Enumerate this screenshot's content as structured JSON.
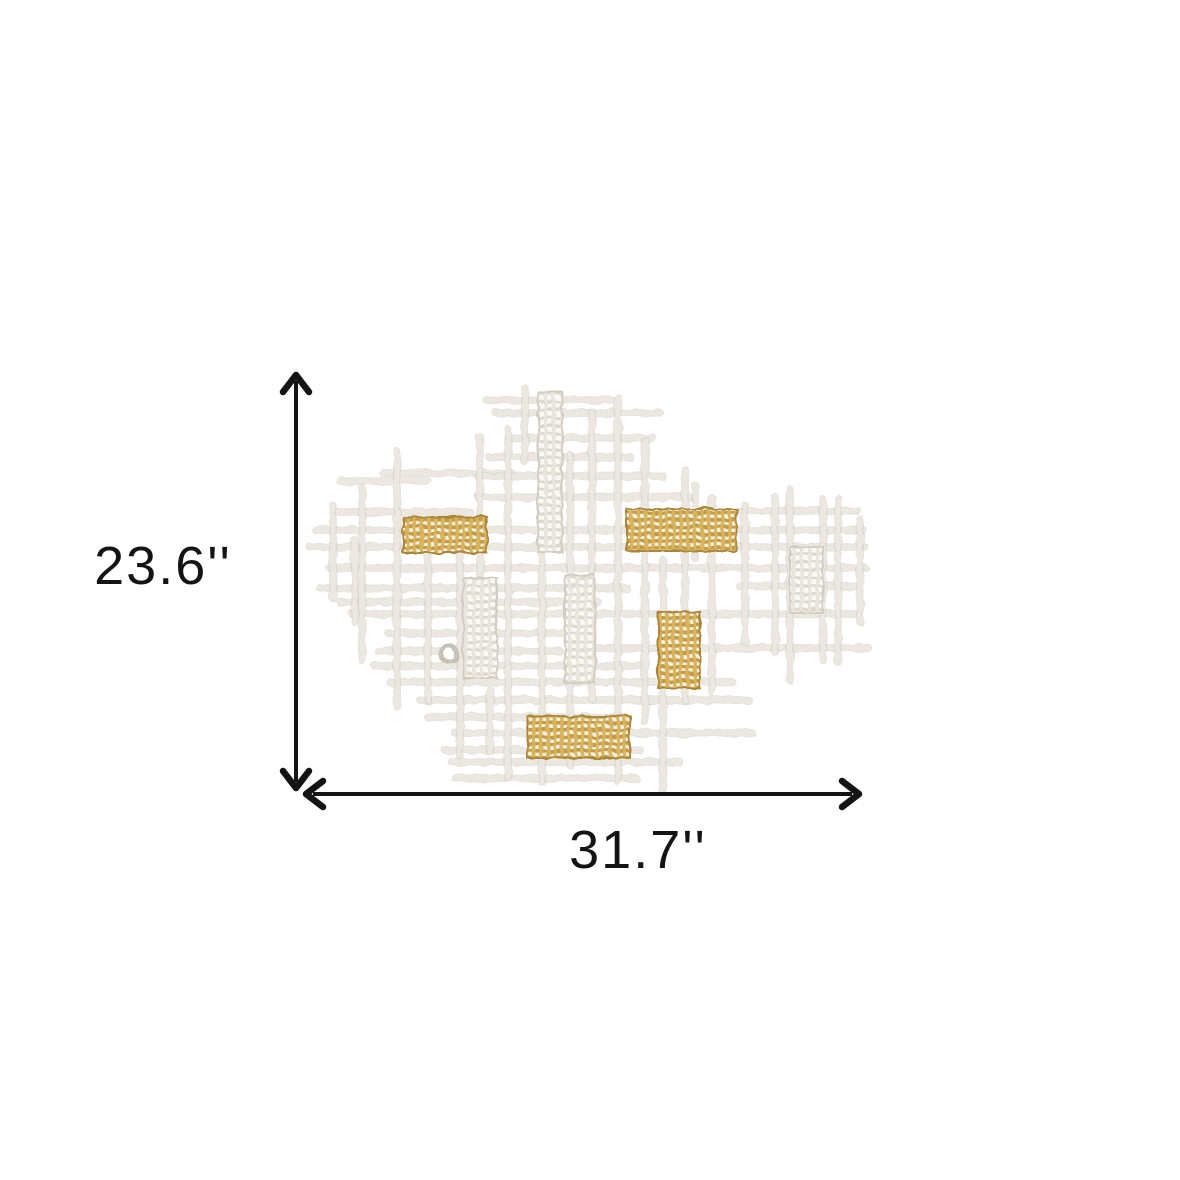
{
  "page": {
    "description": "Product dimension diagram of a white and gold metal grid wall decor piece",
    "background_color": "#ffffff"
  },
  "dimensions": {
    "height": {
      "label": "23.6''"
    },
    "width": {
      "label": "31.7''"
    },
    "arrow_color": "#141414",
    "arrow_style": "double-headed chevron"
  },
  "artwork": {
    "description": "abstract criss-cross grid of textured white metal rods with woven mesh panel accents",
    "colors": {
      "rod_light": "#ece8e1",
      "rod_dark": "#d5cfc4",
      "gold": "#c79f47",
      "gold_dark": "#ab863a",
      "gold_base": "#f3ead2",
      "gold_weft": "#d9b35d",
      "white_mesh_base": "#faf8f5",
      "white_mesh_line": "#ddd7cc",
      "white_mesh_edge": "#d2ccc1",
      "ring": "#c8c1b5"
    },
    "horizontal_rods": [
      [
        400,
        487,
        613
      ],
      [
        413,
        496,
        660
      ],
      [
        438,
        508,
        653
      ],
      [
        457,
        489,
        630
      ],
      [
        473,
        383,
        512
      ],
      [
        476,
        478,
        663
      ],
      [
        481,
        340,
        428
      ],
      [
        497,
        478,
        693
      ],
      [
        512,
        338,
        470
      ],
      [
        511,
        737,
        858
      ],
      [
        530,
        316,
        632
      ],
      [
        530,
        735,
        863
      ],
      [
        547,
        310,
        865
      ],
      [
        568,
        330,
        865
      ],
      [
        588,
        320,
        627
      ],
      [
        586,
        740,
        858
      ],
      [
        602,
        340,
        598
      ],
      [
        614,
        352,
        860
      ],
      [
        633,
        388,
        562
      ],
      [
        648,
        588,
        868
      ],
      [
        651,
        378,
        560
      ],
      [
        666,
        375,
        642
      ],
      [
        682,
        390,
        732
      ],
      [
        700,
        420,
        748
      ],
      [
        717,
        428,
        625
      ],
      [
        733,
        455,
        752
      ],
      [
        750,
        445,
        640
      ],
      [
        762,
        452,
        680
      ],
      [
        778,
        455,
        636
      ]
    ],
    "vertical_rods": [
      [
        333,
        506,
        598
      ],
      [
        355,
        540,
        622
      ],
      [
        362,
        488,
        660
      ],
      [
        397,
        452,
        706
      ],
      [
        428,
        522,
        700
      ],
      [
        460,
        545,
        756
      ],
      [
        480,
        437,
        588
      ],
      [
        490,
        690,
        752
      ],
      [
        508,
        430,
        778
      ],
      [
        525,
        388,
        462
      ],
      [
        542,
        552,
        782
      ],
      [
        570,
        455,
        765
      ],
      [
        592,
        412,
        700
      ],
      [
        618,
        398,
        782
      ],
      [
        645,
        440,
        722
      ],
      [
        663,
        560,
        792
      ],
      [
        685,
        470,
        700
      ],
      [
        695,
        485,
        558
      ],
      [
        712,
        498,
        692
      ],
      [
        745,
        505,
        642
      ],
      [
        775,
        497,
        652
      ],
      [
        790,
        490,
        680
      ],
      [
        823,
        500,
        660
      ],
      [
        838,
        498,
        662
      ],
      [
        860,
        520,
        622
      ]
    ],
    "white_panels": [
      [
        538,
        392,
        24,
        160
      ],
      [
        463,
        578,
        34,
        100
      ],
      [
        565,
        575,
        30,
        108
      ],
      [
        790,
        547,
        33,
        66
      ]
    ],
    "gold_panels": [
      [
        403,
        517,
        84,
        36
      ],
      [
        627,
        509,
        110,
        42
      ],
      [
        658,
        612,
        42,
        76
      ],
      [
        527,
        716,
        103,
        42
      ]
    ],
    "ring": {
      "cx": 449,
      "cy": 654,
      "r": 8
    }
  }
}
